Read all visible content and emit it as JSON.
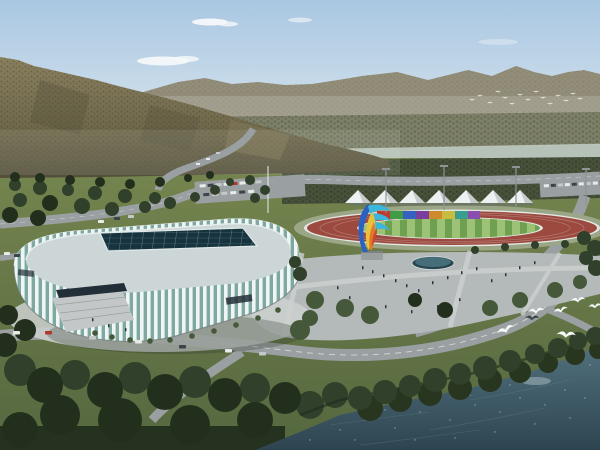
{
  "scene": {
    "type": "aerial architectural rendering",
    "subject": "riverside sports complex with indoor arena and outdoor athletics field",
    "landmarks": [
      {
        "name": "arena",
        "desc": "white vertically-ribbed oval arena with recessed dark glass skylight grid roof"
      },
      {
        "name": "athletics-track",
        "desc": "oval running track, red-brown lanes, green striped infield"
      },
      {
        "name": "canopy-tents",
        "desc": "row of white pyramid canopies behind the track",
        "count": 7
      },
      {
        "name": "color-panel-stand",
        "desc": "multicolored panel wall along north side of track",
        "segments": 8
      },
      {
        "name": "flame-sculpture",
        "desc": "abstract flame/wing sculpture on plaza pedestal",
        "colors": [
          "blue",
          "cyan",
          "yellow",
          "orange",
          "red"
        ]
      },
      {
        "name": "plaza",
        "desc": "grey paved plaza with oval reflecting pool, rows of trees and pedestrians"
      },
      {
        "name": "mountains",
        "desc": "forested olive-brown mountain on left, hazy grey ridge across the right"
      },
      {
        "name": "river",
        "desc": "pale river band below the far ridge"
      },
      {
        "name": "lake",
        "desc": "dark blue-green water across the lower right corner"
      },
      {
        "name": "seagulls",
        "desc": "white gulls over shoreline trees",
        "foreground_count": 7,
        "distant_flock_count": 15
      },
      {
        "name": "roads",
        "desc": "curving access roads with cars, centre parking lot, bottom boulevard"
      }
    ]
  },
  "counts": {
    "tents": 7,
    "panel_segments": 8,
    "floodlight_poles": 4,
    "foreground_gulls": 7
  },
  "panel_colors": [
    "#bf3a31",
    "#3f9b45",
    "#3661c1",
    "#7a3f9e",
    "#cf8a2e",
    "#c8bc3e",
    "#3b9d8f",
    "#8a4fae"
  ],
  "colors": {
    "sky_top": "#a9c7e2",
    "sky_mid": "#cadcea",
    "sky_horizon": "#e4e9e8",
    "cloud": "#f5f8f9",
    "far_mountain": "#938e7a",
    "far_base": "#7e8068",
    "haze": "#eef1f0",
    "mtn_light": "#8a8060",
    "mtn_mid": "#6f684b",
    "mtn_dark": "#544f3a",
    "mtn_dot": "#49452f",
    "river": "#b6c2b8",
    "band_tree": "#48523a",
    "band_dot": "#2c3625",
    "ground_top": "#75864f",
    "ground_bottom": "#55673f",
    "road": "#9aa0a2",
    "road_line": "#e9eceb",
    "plaza": "#b4b9ba",
    "plaza_light": "#cdd1d0",
    "apron": "#9ba687",
    "curb": "#e3e7e3",
    "track_red": "#9c4a40",
    "infield": "#6fa050",
    "stripe": "#9cc276",
    "lane": "#e8dcd6",
    "tent": "#eef1f1",
    "tent_shade": "#c6cbcd",
    "tent_base": "#6a7370",
    "pole": "#8d9496",
    "flag_pole": "#e8ecec",
    "rib": "#eff4f4",
    "glass": "#7fa8a1",
    "roof": "#cdd6d6",
    "roof_edge": "#e9efef",
    "skylight": "#17333e",
    "sky_grid": "#a8c6cc",
    "entrance": "#232f38",
    "steps": "#c3c7c7",
    "step_line": "#9aa0a0",
    "shadow": "#2c3526",
    "tree_dark": "#232f1d",
    "tree_mid": "#31402a",
    "tree_light": "#45583a",
    "shore_tree": "#28351f",
    "pool_dark": "#27454e",
    "pool_light": "#7fb9c8",
    "people": "#2e343c",
    "car_white": "#e9ebeb",
    "car_dark": "#3d434b",
    "car_red": "#b2372a",
    "car_silver": "#c4c8ca",
    "water_top": "#51707d",
    "water_bottom": "#2e4551",
    "sparkle": "#d3e2e6",
    "reflection": "#b9c9cc",
    "bird_white": "#f6f9f9",
    "bird_dark": "#3c4648",
    "pedestal": "#9aa0a0",
    "sc_blue": "#2a62c2",
    "sc_cyan": "#3cb6dc",
    "sc_yellow": "#e9c23c",
    "sc_orange": "#e2782a",
    "sc_red": "#cc4424"
  }
}
